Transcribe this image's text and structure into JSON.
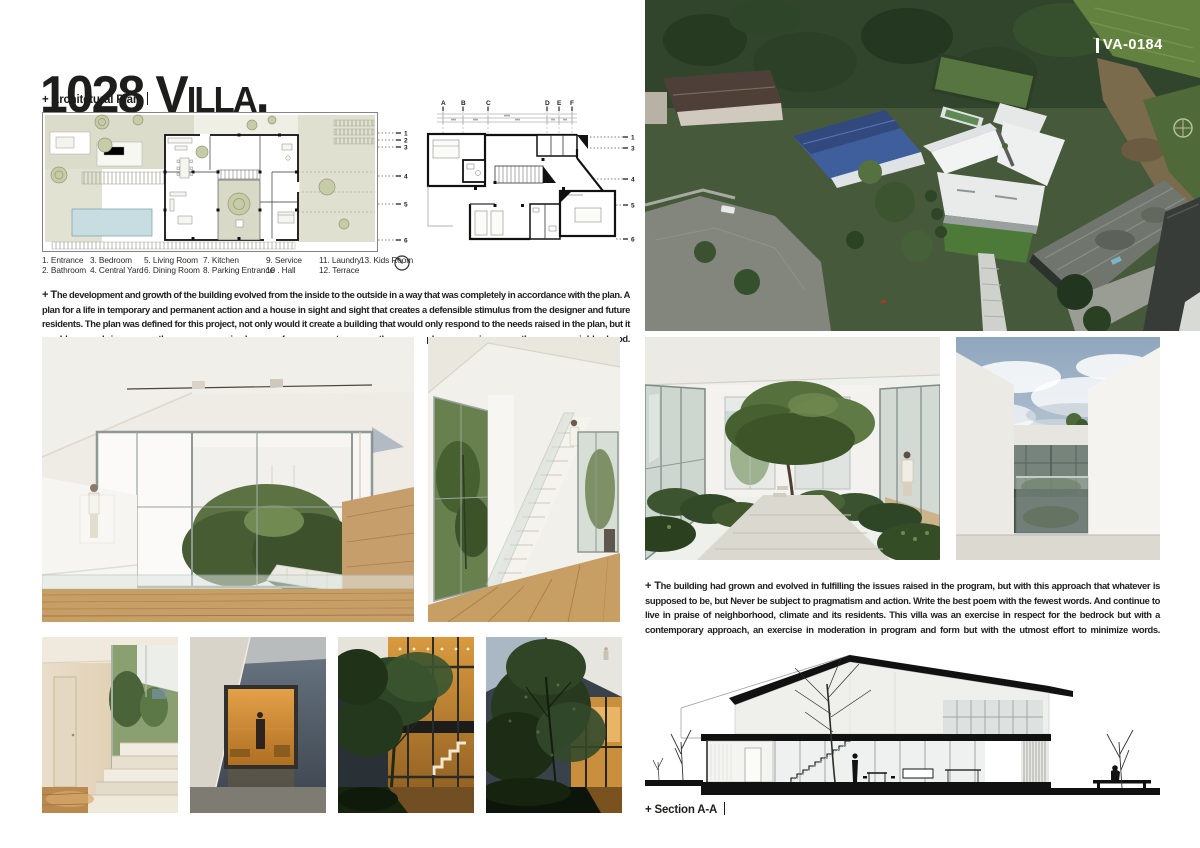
{
  "header": {
    "title": "1028 Villa.",
    "plan_label": "+ Architetural Plan"
  },
  "plans": {
    "grid_letters": [
      "A",
      "B",
      "C",
      "D",
      "E",
      "F"
    ],
    "ground_grid_numbers": [
      "1",
      "2",
      "3",
      "4",
      "5",
      "6"
    ],
    "upper_grid_numbers": [
      "1",
      "3",
      "4",
      "5",
      "6"
    ],
    "legend": [
      "1. Entrance",
      "2. Bathroom",
      "3. Bedroom",
      "4. Central Yard",
      "5. Living Room",
      "6. Dining Room",
      "7. Kitchen",
      "8. Parking Entrance",
      "9. Service",
      "10 . Hall",
      "11. Laundry",
      "12. Terrace",
      "13. Kids Room"
    ],
    "description_lead": "+ T",
    "description_rest": "he development and growth of the building evolved from the inside to the outside in a way that was completely in accordance with the plan. A plan for a life in temporary and permanent action and a house in sight and sight that creates a defensible stimulus from the designer and future residents. The plan was defined for this project, not only would it create a building that would only respond to the needs raised in the plan, but it would bring the organized form to the plan in the neighborhood."
  },
  "aerial": {
    "code": "VA-0184"
  },
  "statement": {
    "lead": "+ T",
    "rest": "he building had grown and evolved in fulfilling the issues raised in the program, but with this approach that whatever is supposed to be, but Never be subject to pragmatism and action. Write the best poem with the fewest words. And continue to live in praise of neighborhood, climate and its residents. This villa was an exercise in respect for the bedrock but with a contemporary approach, an exercise in moderation in program and form but with the utmost effort to minimize words."
  },
  "section": {
    "label": "+ Section A-A"
  },
  "colors": {
    "ink": "#1d1d1b",
    "photo_code_text": "#ffffff",
    "plan_site": "#dcdccb",
    "pool": "#c7dde2",
    "foliage": "#4a6338",
    "wood_floor": "#c59e66"
  }
}
